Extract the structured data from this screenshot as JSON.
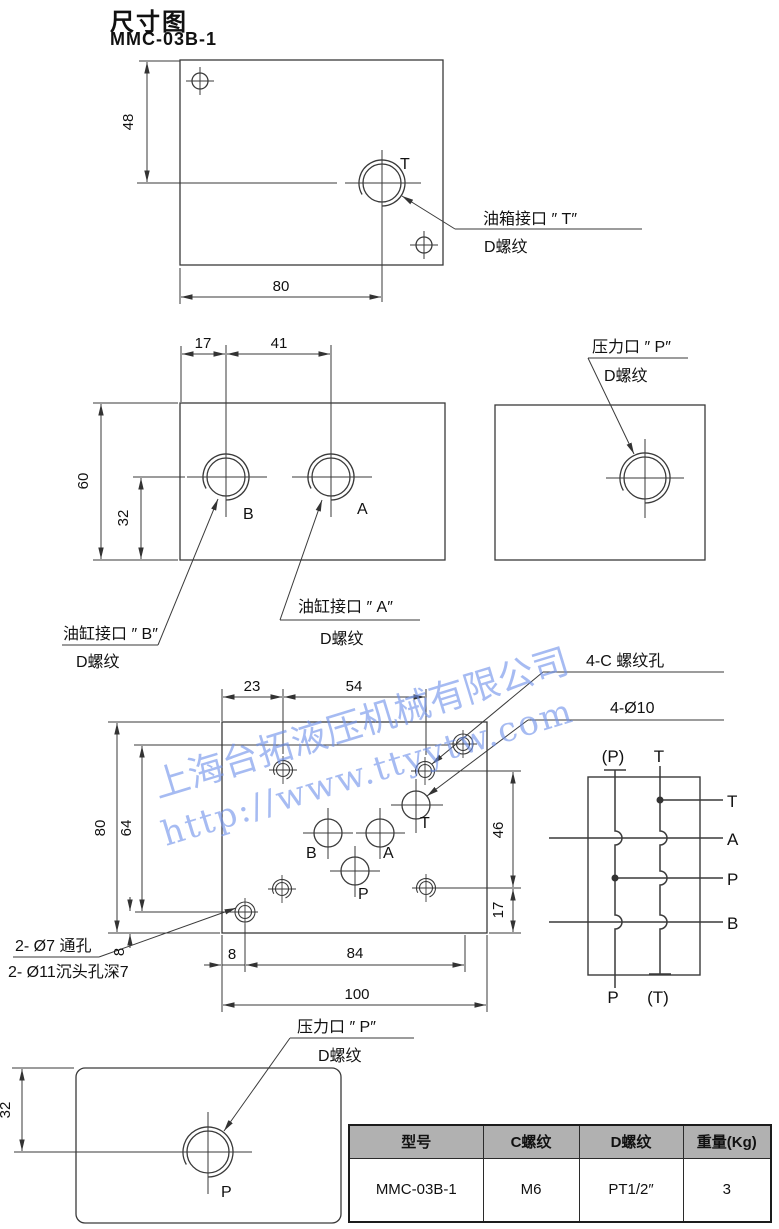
{
  "page": {
    "title": "尺寸图",
    "model": "MMC-03B-1"
  },
  "watermark": {
    "line1": "上海台拓液压机械有限公司",
    "line2": "http://www.ttyytw.com",
    "color": "#6f92ea"
  },
  "top_view": {
    "dim_48": "48",
    "dim_80": "80",
    "port_t": "T",
    "ann_line1": "油箱接口 ″ T″",
    "ann_line2": "D螺纹"
  },
  "front_view": {
    "dim_17": "17",
    "dim_41": "41",
    "dim_60": "60",
    "dim_32": "32",
    "port_b": "B",
    "port_a": "A",
    "ann_b_line1": "油缸接口 ″ B″",
    "ann_b_line2": "D螺纹",
    "ann_a_line1": "油缸接口 ″ A″",
    "ann_a_line2": "D螺纹"
  },
  "side_view": {
    "ann_line1": "压力口 ″ P″",
    "ann_line2": "D螺纹"
  },
  "mount_view": {
    "dim_23": "23",
    "dim_54": "54",
    "dim_80": "80",
    "dim_64": "64",
    "dim_8v": "8",
    "dim_46": "46",
    "dim_17": "17",
    "dim_8h": "8",
    "dim_84": "84",
    "dim_100": "100",
    "port_b": "B",
    "port_a": "A",
    "port_p": "P",
    "port_t": "T",
    "ann_cthread": "4-C 螺纹孔",
    "ann_d10": "4-Ø10",
    "ann_through": "2- Ø7 通孔",
    "ann_counterbore": "2- Ø11沉头孔深7"
  },
  "bottom_view": {
    "dim_32": "32",
    "port_p": "P",
    "ann_line1": "压力口 ″ P″",
    "ann_line2": "D螺纹"
  },
  "schematic": {
    "top_left": "(P)",
    "top_right": "T",
    "right_t": "T",
    "right_a": "A",
    "right_p": "P",
    "right_b": "B",
    "bottom_left": "P",
    "bottom_right": "(T)"
  },
  "table": {
    "headers": [
      "型号",
      "C螺纹",
      "D螺纹",
      "重量(Kg)"
    ],
    "row": [
      "MMC-03B-1",
      "M6",
      "PT1/2″",
      "3"
    ]
  }
}
